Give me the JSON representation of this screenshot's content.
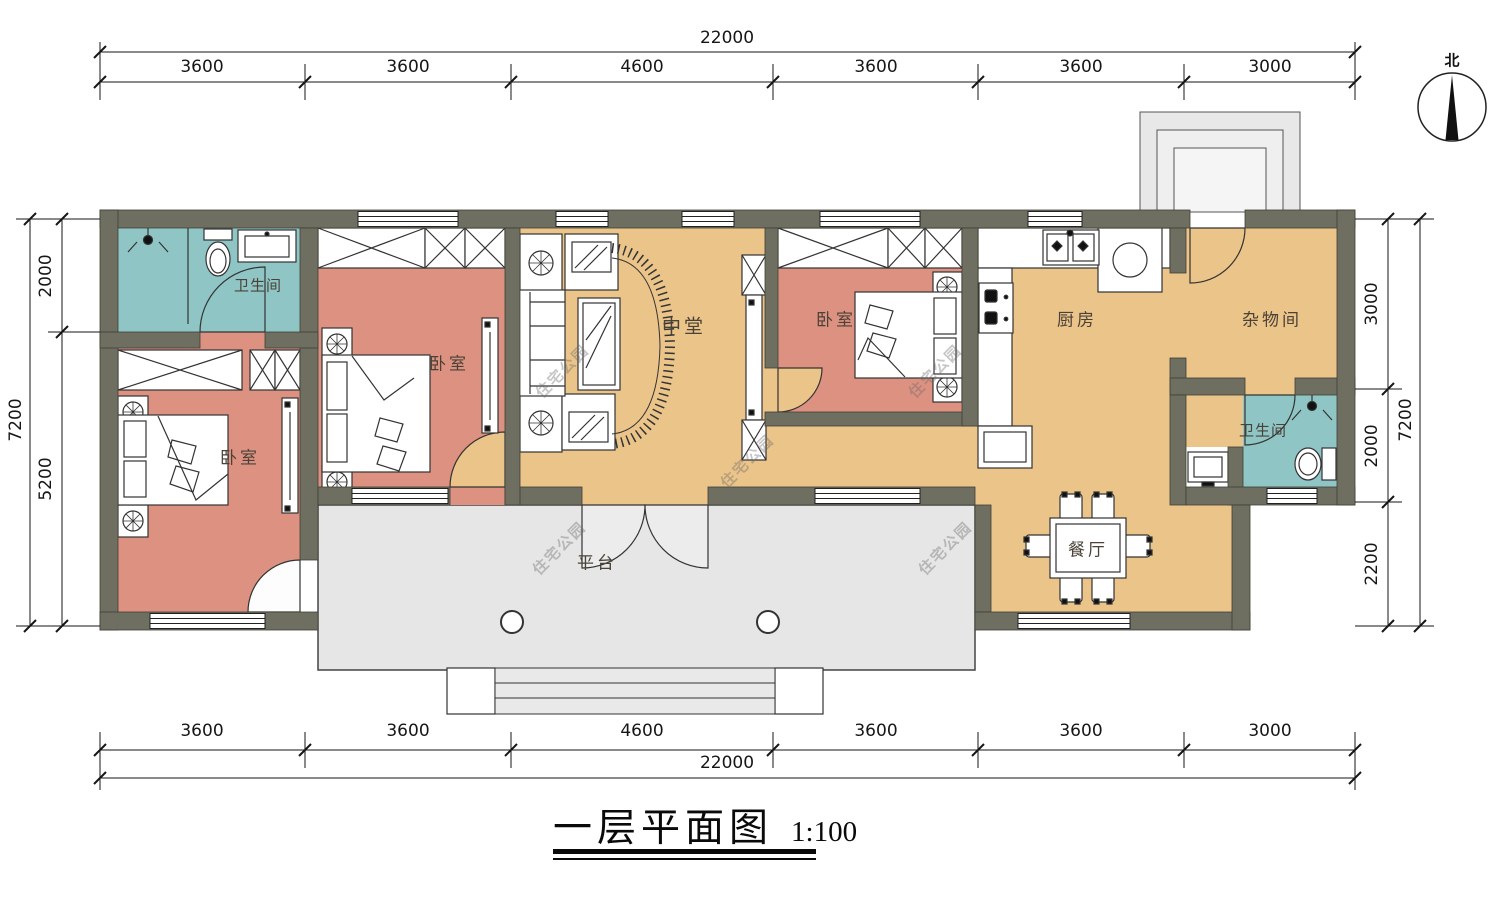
{
  "meta": {
    "title": "一层平面图",
    "scale": "1:100",
    "north": "北",
    "watermark": "住宅公园"
  },
  "palette": {
    "wall": "#6e6e61",
    "bedroom_floor": "#dd9181",
    "bathroom_floor": "#8fc5c4",
    "living_floor": "#ebc489",
    "platform_floor": "#e6e6e6",
    "linework": "#333333"
  },
  "rooms": {
    "bathroom_left": "卫生间",
    "bedroom_left": "卧室",
    "bedroom_middle": "卧室",
    "hall": "中堂",
    "bedroom_right": "卧室",
    "kitchen": "厨房",
    "storage": "杂物间",
    "bathroom_right": "卫生间",
    "dining": "餐厅",
    "platform": "平台"
  },
  "dims": {
    "top": {
      "total": "22000",
      "segments": [
        "3600",
        "3600",
        "4600",
        "3600",
        "3600",
        "3000"
      ]
    },
    "bottom": {
      "total": "22000",
      "segments": [
        "3600",
        "3600",
        "4600",
        "3600",
        "3600",
        "3000"
      ]
    },
    "left": {
      "total": "7200",
      "segments": [
        "2000",
        "5200"
      ]
    },
    "right": {
      "total": "7200",
      "segments": [
        "3000",
        "2000",
        "2200"
      ]
    }
  }
}
